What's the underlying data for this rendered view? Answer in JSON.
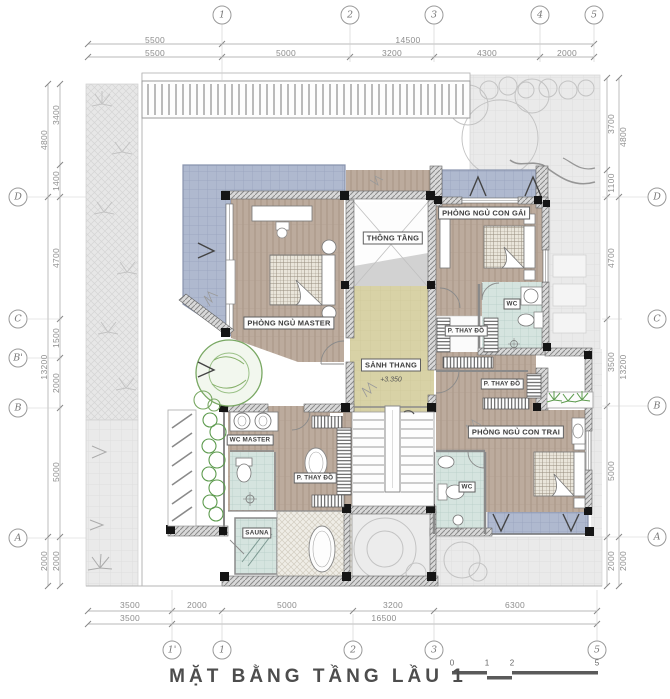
{
  "title": "MẶT BẰNG TẦNG LẦU 1",
  "scale_bar": {
    "ticks": [
      "0",
      "1",
      "2",
      "5"
    ]
  },
  "grid": {
    "top": [
      "1",
      "2",
      "3",
      "4",
      "5"
    ],
    "bottom": [
      "1'",
      "1",
      "2",
      "3",
      "5"
    ],
    "left": [
      "D",
      "C",
      "B'",
      "B",
      "A"
    ],
    "right": [
      "D",
      "C",
      "B",
      "A"
    ]
  },
  "dims": {
    "top_overall": [
      "5500",
      "14500"
    ],
    "top_seg": [
      "5500",
      "5000",
      "3200",
      "4300",
      "2000"
    ],
    "bottom_seg": [
      "3500",
      "2000",
      "5000",
      "3200",
      "6300"
    ],
    "bottom_overall": [
      "3500",
      "16500"
    ],
    "left_outer": [
      "4800",
      "13200",
      "2000"
    ],
    "left_inner": [
      "3400",
      "1400",
      "4700",
      "1500",
      "2000",
      "5000",
      "2000"
    ],
    "right_inner": [
      "3700",
      "1100",
      "4700",
      "3500",
      "5000",
      "2000"
    ],
    "right_outer": [
      "4800",
      "13200",
      "2000"
    ]
  },
  "rooms": {
    "master": "PHÒNG NGỦ MASTER",
    "void": "THÔNG TẦNG",
    "daughter": "PHÒNG NGỦ CON GÁI",
    "wc_daughter": "WC",
    "dress_daughter": "P. THAY ĐỒ",
    "hall": "SẢNH THANG",
    "hall_level": "+3.350",
    "dress_son": "P. THAY ĐỒ",
    "son": "PHÒNG NGỦ CON TRAI",
    "wc_master": "WC MASTER",
    "dress_master": "P. THAY ĐỒ",
    "wc_son": "WC",
    "sauna": "SAUNA"
  },
  "colors": {
    "balcony": "#afb9cf",
    "wood_floor": "#bcab9d",
    "bathroom": "#d5e4df",
    "stair_hall": "#d8d2a6",
    "site": "#eaeaea",
    "wall": "#d9d9d9",
    "plant_green": "#79a863"
  }
}
